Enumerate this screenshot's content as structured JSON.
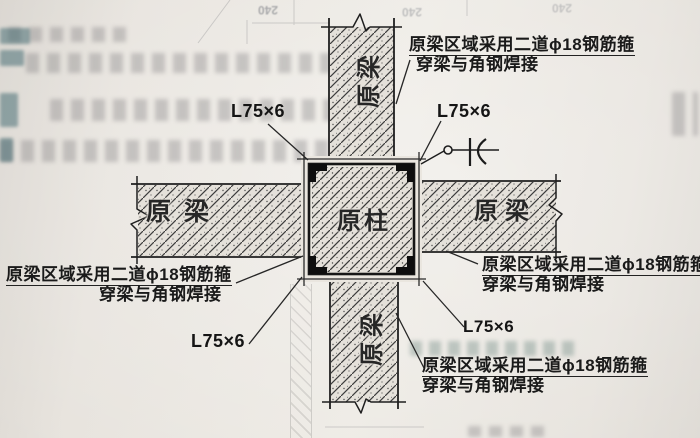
{
  "figure": {
    "kind": "column-beam joint strengthening detail (photographed drawing)",
    "column_label": "原柱",
    "beam_label": "原梁",
    "angle_label": "L75×6",
    "note_line1": "原梁区域采用二道ϕ18钢筋箍",
    "note_line2": "穿梁与角钢焊接",
    "bleedthrough_dim": "240",
    "colors": {
      "paper": "#e9e5de",
      "ink": "#1f1f1f",
      "hatch": "#3a3a3a",
      "teal_bleed": "#3a646c"
    }
  }
}
